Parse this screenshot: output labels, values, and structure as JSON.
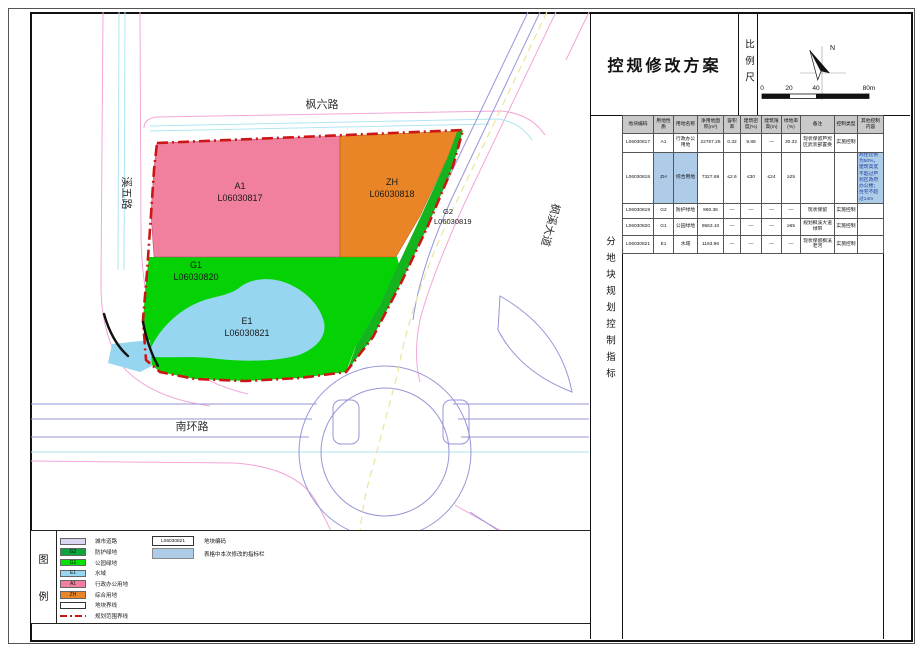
{
  "colors": {
    "boundary": "#cc1616",
    "road_pink": "#f2a6d8",
    "road_blue": "#9596d6",
    "road_cyan": "#aee6f0",
    "centerline": "#ebe49c",
    "water_edge": "#4a88c8",
    "highlight": "#aecce8"
  },
  "title_block": {
    "title": "控规修改方案",
    "scale_label": "比例尺",
    "north_label": "N",
    "scale_ticks": [
      "0",
      "20",
      "40",
      "80m"
    ]
  },
  "side_label": "分地块规划控制指标",
  "map": {
    "roads": [
      {
        "name": "枫六路"
      },
      {
        "name": "溪五路"
      },
      {
        "name": "枫溪大道"
      },
      {
        "name": "南环路"
      }
    ],
    "parcels": [
      {
        "code": "A1",
        "id": "L06030817",
        "color": "#f0809e"
      },
      {
        "code": "ZH",
        "id": "L06030818",
        "color": "#e98427"
      },
      {
        "code": "G2",
        "id": "L06030819",
        "color": "#14b41e"
      },
      {
        "code": "G1",
        "id": "L06030820",
        "color": "#04d204"
      },
      {
        "code": "E1",
        "id": "L06030821",
        "color": "#96d6f0"
      }
    ]
  },
  "table": {
    "columns": [
      "地块编码",
      "用地性质",
      "用地名称",
      "净用地面积(m²)",
      "容积率",
      "建筑密度(%)",
      "建筑限高(m)",
      "绿地率(%)",
      "备注",
      "控制类型",
      "其他控制内容"
    ],
    "rows": [
      {
        "cells": [
          "L06030817",
          "A1",
          "行政办公用地",
          "22767.26",
          "0.32",
          "9.88",
          "—",
          "30.32",
          "现状保留芦淞区武装部置换",
          "实施控制",
          ""
        ],
        "highlight": []
      },
      {
        "cells": [
          "L06030818",
          "ZH",
          "综合用地",
          "7327.69",
          "≤2.6",
          "≤30",
          "≤24",
          "≥25",
          "",
          "",
          "商住比例为50%，建筑高度不超过芦淞区政府办公楼；住宅不超过14m"
        ],
        "highlight": [
          1,
          2,
          10
        ]
      },
      {
        "cells": [
          "L06030819",
          "G2",
          "防护绿地",
          "960.36",
          "—",
          "—",
          "—",
          "—",
          "现状保留",
          "实施控制",
          ""
        ],
        "highlight": []
      },
      {
        "cells": [
          "L06030820",
          "G1",
          "公园绿地",
          "9563.10",
          "—",
          "—",
          "—",
          "≥65",
          "规划枫溪大道绿带",
          "实施控制",
          ""
        ],
        "highlight": []
      },
      {
        "cells": [
          "L06030821",
          "E1",
          "水域",
          "1163.96",
          "—",
          "—",
          "—",
          "—",
          "现状保留枫溪老河",
          "实施控制",
          ""
        ],
        "highlight": []
      }
    ]
  },
  "legend": {
    "title_chars": [
      "图",
      "例"
    ],
    "items": [
      {
        "code": "",
        "label": "城市道路",
        "color": "#d8d6f2",
        "style": "fill"
      },
      {
        "code": "G2",
        "label": "防护绿地",
        "color": "#0ba53e",
        "style": "fill"
      },
      {
        "code": "G1",
        "label": "公园绿地",
        "color": "#04e204",
        "style": "fill"
      },
      {
        "code": "E1",
        "label": "水域",
        "color": "#96d6f0",
        "style": "fill"
      },
      {
        "code": "A1",
        "label": "行政办公用地",
        "color": "#f0809e",
        "style": "fill"
      },
      {
        "code": "ZH",
        "label": "综合用地",
        "color": "#e98427",
        "style": "fill"
      },
      {
        "code": "",
        "label": "地块界线",
        "color": "#ffffff",
        "style": "outline"
      },
      {
        "code": "",
        "label": "规划范围界线",
        "color": "#cc1616",
        "style": "dash"
      }
    ],
    "code_sample": {
      "value": "L06030821",
      "label": "地块编码"
    },
    "highlight_sample": {
      "label": "表格中本次修改的指标栏",
      "color": "#aecce8"
    }
  }
}
